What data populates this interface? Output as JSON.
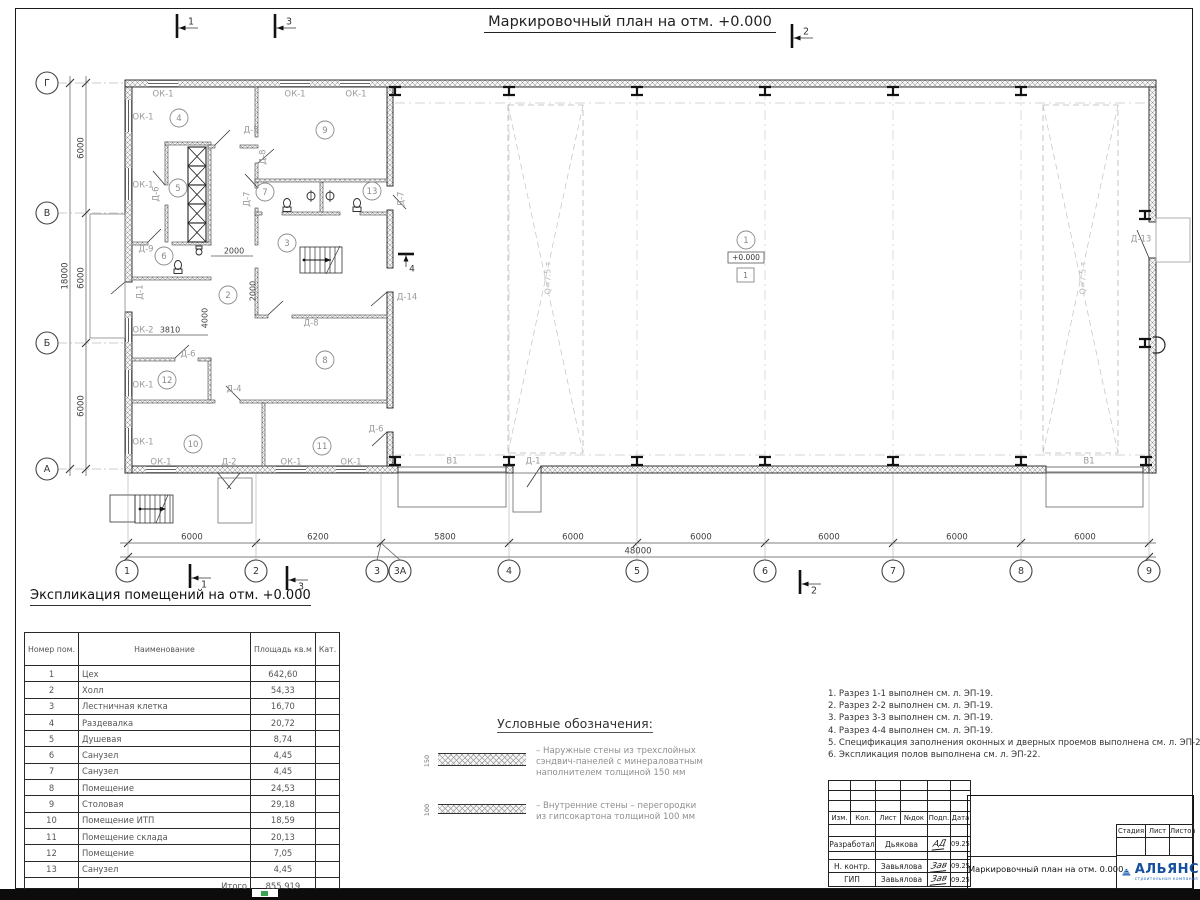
{
  "sheet": {
    "plan_title": "Маркировочный план на отм. +0.000",
    "expl_title": "Экспликация помещений на отм. +0.000"
  },
  "plan": {
    "elevation": "+0.000",
    "elevation_zone": "1",
    "axes_bottom": [
      "1",
      "2",
      "3",
      "3А",
      "4",
      "5",
      "6",
      "7",
      "8",
      "9"
    ],
    "axes_left": [
      "Г",
      "В",
      "Б",
      "А"
    ],
    "dims_bottom": [
      "6000",
      "6200",
      "5800",
      "6000",
      "6000",
      "6000",
      "6000",
      "6000"
    ],
    "dim_bottom_total": "48000",
    "dims_left": [
      "6000",
      "6000",
      "6000"
    ],
    "dim_left_total": "18000",
    "flags": [
      "1",
      "3",
      "2",
      "1",
      "3",
      "2",
      "4"
    ],
    "rooms": [
      {
        "n": "1",
        "x": 746,
        "y": 240
      },
      {
        "n": "2",
        "x": 228,
        "y": 295
      },
      {
        "n": "3",
        "x": 287,
        "y": 243
      },
      {
        "n": "4",
        "x": 179,
        "y": 118
      },
      {
        "n": "5",
        "x": 178,
        "y": 188
      },
      {
        "n": "6",
        "x": 164,
        "y": 256
      },
      {
        "n": "7",
        "x": 265,
        "y": 192
      },
      {
        "n": "8",
        "x": 325,
        "y": 360
      },
      {
        "n": "9",
        "x": 325,
        "y": 130
      },
      {
        "n": "10",
        "x": 193,
        "y": 444
      },
      {
        "n": "11",
        "x": 322,
        "y": 446
      },
      {
        "n": "12",
        "x": 167,
        "y": 380
      },
      {
        "n": "13",
        "x": 372,
        "y": 191
      }
    ],
    "labels": [
      [
        "ОК-1",
        163,
        94,
        0,
        "op"
      ],
      [
        "ОК-1",
        295,
        94,
        0,
        "op"
      ],
      [
        "ОК-1",
        356,
        94,
        0,
        "op"
      ],
      [
        "ОК-1",
        143,
        117,
        0,
        "op"
      ],
      [
        "ОК-1",
        143,
        185,
        0,
        "op"
      ],
      [
        "ОК-2",
        143,
        330,
        0,
        "op"
      ],
      [
        "ОК-1",
        143,
        385,
        0,
        "op"
      ],
      [
        "ОК-1",
        143,
        442,
        0,
        "op"
      ],
      [
        "ОК-1",
        161,
        462,
        0,
        "op"
      ],
      [
        "Д-2",
        229,
        462,
        0,
        "op"
      ],
      [
        "ОК-1",
        291,
        462,
        0,
        "op"
      ],
      [
        "ОК-1",
        351,
        462,
        0,
        "op"
      ],
      [
        "В1",
        452,
        461,
        0,
        "op"
      ],
      [
        "Д-1",
        533,
        461,
        0,
        "op"
      ],
      [
        "В1",
        1089,
        461,
        0,
        "op"
      ],
      [
        "Д-5",
        251,
        130,
        0,
        "op"
      ],
      [
        "Д-8",
        263,
        157,
        -90,
        "op"
      ],
      [
        "Д-7",
        247,
        199,
        -90,
        "op"
      ],
      [
        "Д-7",
        401,
        199,
        -90,
        "op"
      ],
      [
        "Д-9",
        146,
        249,
        0,
        "op"
      ],
      [
        "Д-6",
        156,
        194,
        -90,
        "op"
      ],
      [
        "Д-6",
        188,
        354,
        0,
        "op"
      ],
      [
        "Д-4",
        234,
        389,
        0,
        "op"
      ],
      [
        "Д-8",
        311,
        323,
        0,
        "op"
      ],
      [
        "Д-14",
        407,
        297,
        0,
        "op"
      ],
      [
        "Д-6",
        376,
        429,
        0,
        "op"
      ],
      [
        "Д-13",
        1141,
        239,
        0,
        "op"
      ],
      [
        "Д-1",
        140,
        292,
        -90,
        "op"
      ],
      [
        "2000",
        234,
        251,
        0,
        "dim"
      ],
      [
        "3810",
        170,
        330,
        0,
        "dim"
      ],
      [
        "4000",
        205,
        318,
        -90,
        "dim"
      ],
      [
        "2000",
        253,
        291,
        -90,
        "dim"
      ],
      [
        "Q=7.5 т",
        548,
        278,
        -90,
        "crane"
      ],
      [
        "Q=7.5 т",
        1083,
        278,
        -90,
        "crane"
      ]
    ]
  },
  "expl_table": {
    "headers": [
      "Номер пом.",
      "Наименование",
      "Площадь кв.м",
      "Кат."
    ],
    "rows": [
      [
        "1",
        "Цех",
        "642,60"
      ],
      [
        "2",
        "Холл",
        "54,33"
      ],
      [
        "3",
        "Лестничная клетка",
        "16,70"
      ],
      [
        "4",
        "Раздевалка",
        "20,72"
      ],
      [
        "5",
        "Душевая",
        "8,74"
      ],
      [
        "6",
        "Санузел",
        "4,45"
      ],
      [
        "7",
        "Санузел",
        "4,45"
      ],
      [
        "8",
        "Помещение",
        "24,53"
      ],
      [
        "9",
        "Столовая",
        "29,18"
      ],
      [
        "10",
        "Помещение ИТП",
        "18,59"
      ],
      [
        "11",
        "Помещение склада",
        "20,13"
      ],
      [
        "12",
        "Помещение",
        "7,05"
      ],
      [
        "13",
        "Санузел",
        "4,45"
      ]
    ],
    "total_label": "Итого",
    "total_value": "855,919"
  },
  "legend": {
    "title": "Условные обозначения:",
    "items": [
      {
        "dim": "150",
        "text": "– Наружные стены из трехслойных\nсэндвич-панелей с минераловатным\nнаполнителем толщиной 150 мм"
      },
      {
        "dim": "100",
        "text": "– Внутренние стены – перегородки\nиз гипсокартона толщиной 100 мм"
      }
    ]
  },
  "notes": [
    "1. Разрез 1-1 выполнен см. л. ЭП-19.",
    "2. Разрез 2-2 выполнен см. л. ЭП-19.",
    "3. Разрез 3-3 выполнен см. л. ЭП-19.",
    "4. Разрез 4-4 выполнен см. л. ЭП-19.",
    "5. Спецификация заполнения оконных и дверных проемов выполнена см. л. ЭП-21, ЭП-22.",
    "6. Экспликация полов выполнена см. л. ЭП-22."
  ],
  "titleblock": {
    "cols": [
      "Изм.",
      "Кол.",
      "Лист",
      "№док",
      "Подп.",
      "Дата"
    ],
    "rows": [
      {
        "role": "Разработал",
        "name": "Дьякова",
        "sig": "АД",
        "date": "09.25"
      },
      {
        "role": "Н. контр.",
        "name": "Завьялова",
        "sig": "Зав",
        "date": "09.25"
      },
      {
        "role": "ГИП",
        "name": "Завьялова",
        "sig": "Зав",
        "date": "09.25"
      }
    ],
    "doc_title": "Маркировочный план на отм. 0.000",
    "stage_cols": [
      "Стадия",
      "Лист",
      "Листов"
    ],
    "company": "АЛЬЯНС",
    "company_sub": "строительная компания"
  }
}
